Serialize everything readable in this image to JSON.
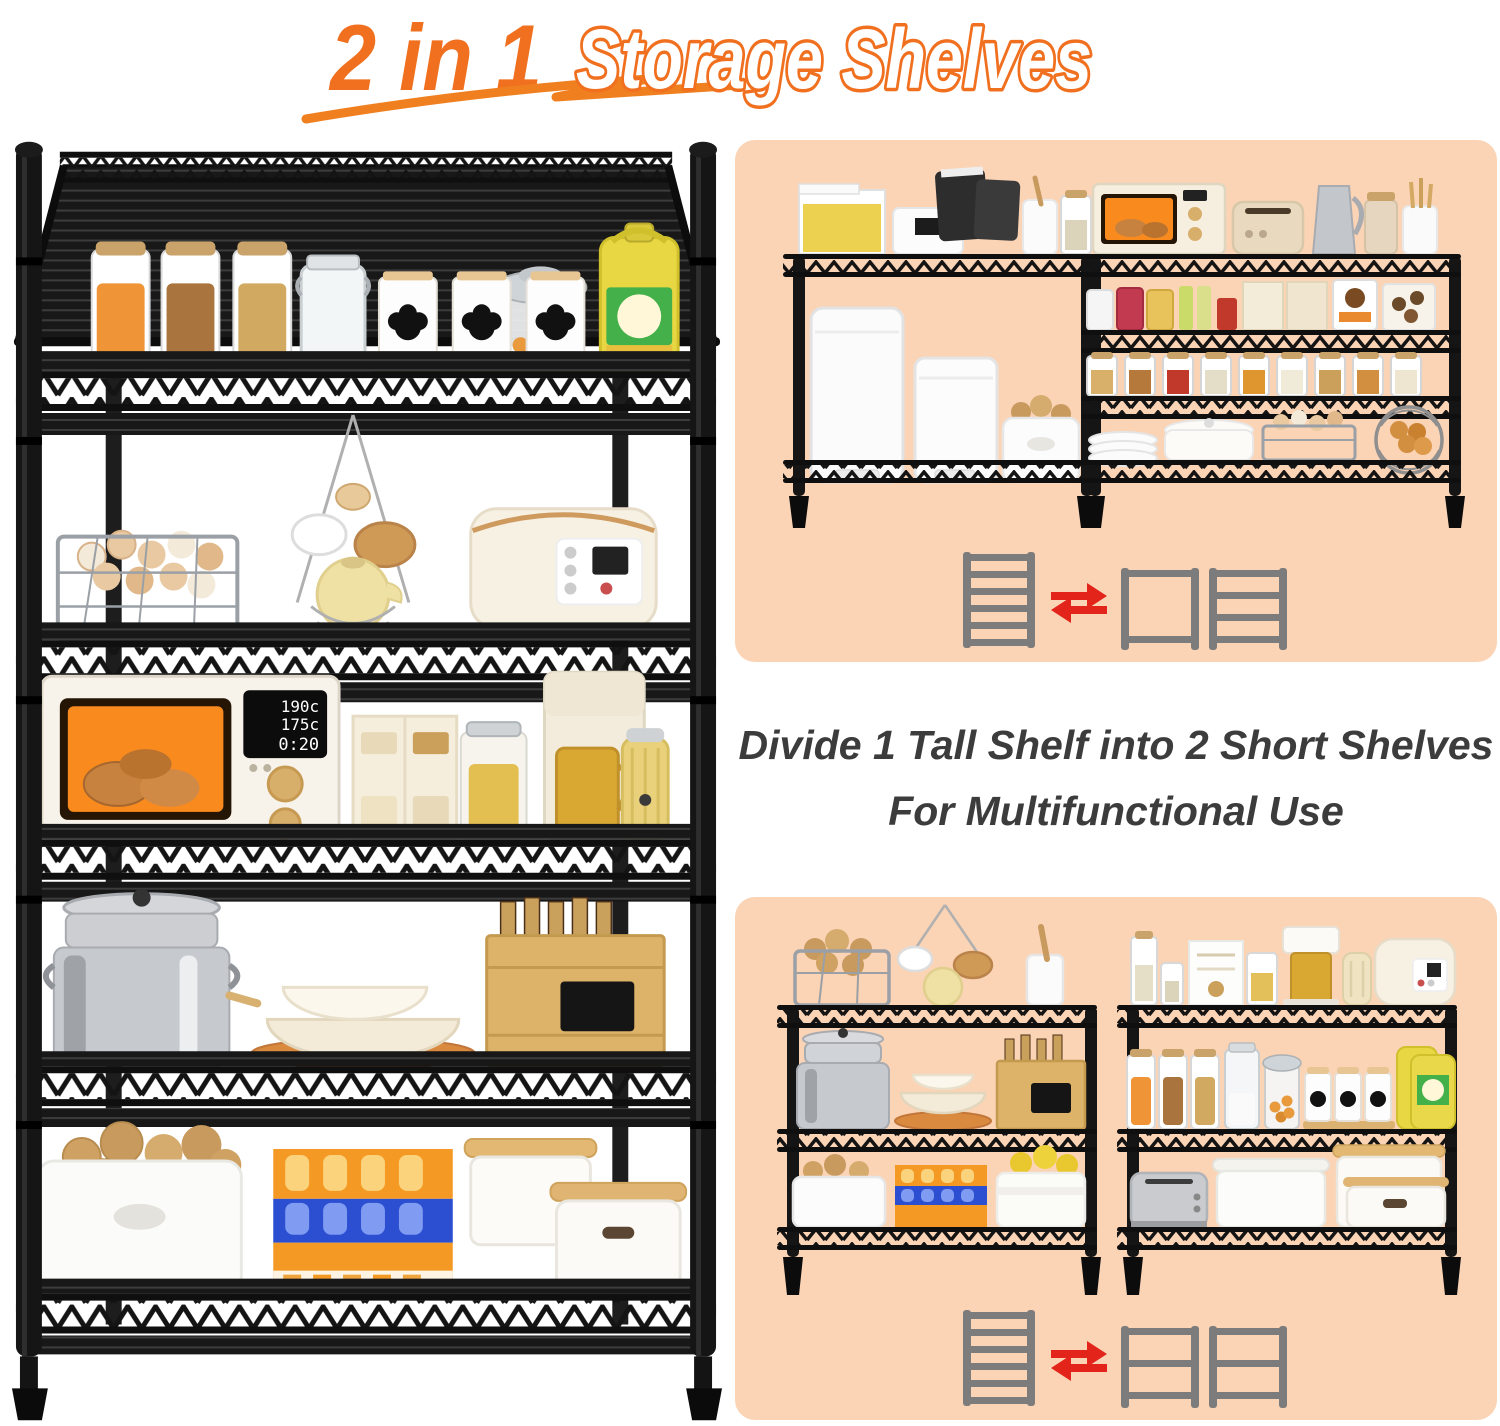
{
  "title": {
    "part1": "2 in 1",
    "part2": "Storage Shelves"
  },
  "caption": {
    "line1": "Divide 1 Tall Shelf into 2 Short Shelves",
    "line2": "For Multifunctional Use"
  },
  "tall_shelf": {
    "tiers": 6,
    "microwave_display": {
      "l1": "190c",
      "l2": "175c",
      "l3": "0:20"
    },
    "items": [
      "snack canisters",
      "chalkboard jars",
      "candy jar",
      "cooking oil bottle",
      "egg basket",
      "hanging cups rack",
      "teapot",
      "rice cooker",
      "microwave oven",
      "food boxes",
      "cracker jar",
      "coffee maker",
      "milk frother",
      "steamer pot",
      "bowl stack",
      "wooden crate with bottles",
      "potato bin",
      "juice packs",
      "storage boxes with wooden lids"
    ]
  },
  "panel_top": {
    "left_shelf_tiers": 2,
    "right_shelf_tiers": 4,
    "items": [
      "pasta container",
      "storage basket",
      "snack pouches",
      "canister",
      "glass jars",
      "pedal trash cans",
      "potato bin",
      "toaster oven",
      "toaster",
      "pitcher",
      "utensil holder",
      "jam jars",
      "snack boxes",
      "pantry canisters",
      "plate stack",
      "white pot",
      "egg basket",
      "onion basket"
    ],
    "icons": [
      "tall-shelf-icon",
      "swap-arrows-icon",
      "short-shelf-2-tier-icon",
      "short-shelf-4-tier-icon"
    ]
  },
  "panel_bottom": {
    "left_shelf_tiers": 3,
    "right_shelf_tiers": 3,
    "items": [
      "wire potato basket",
      "hanging cups",
      "teapot",
      "canister",
      "steamer pot",
      "bowl stack",
      "wooden crate",
      "potato bin",
      "juice packs",
      "lemon bin",
      "glass jars",
      "packet box",
      "coffee machine",
      "milk frother",
      "rice cooker",
      "snack canisters",
      "flour jar",
      "chalkboard jars",
      "oil bottles",
      "toaster",
      "storage boxes"
    ],
    "icons": [
      "tall-shelf-icon",
      "swap-arrows-icon",
      "short-shelf-3-tier-icon",
      "short-shelf-3-tier-icon"
    ]
  },
  "colors": {
    "accent_orange": "#f0701f",
    "outline_text_fill": "#ffffff",
    "caption_text": "#3c3c3c",
    "panel_peach": "#fbd3b5",
    "shelf_black": "#141414",
    "icon_gray": "#7c7c7c",
    "arrow_red": "#e2241b",
    "background": "#ffffff"
  }
}
